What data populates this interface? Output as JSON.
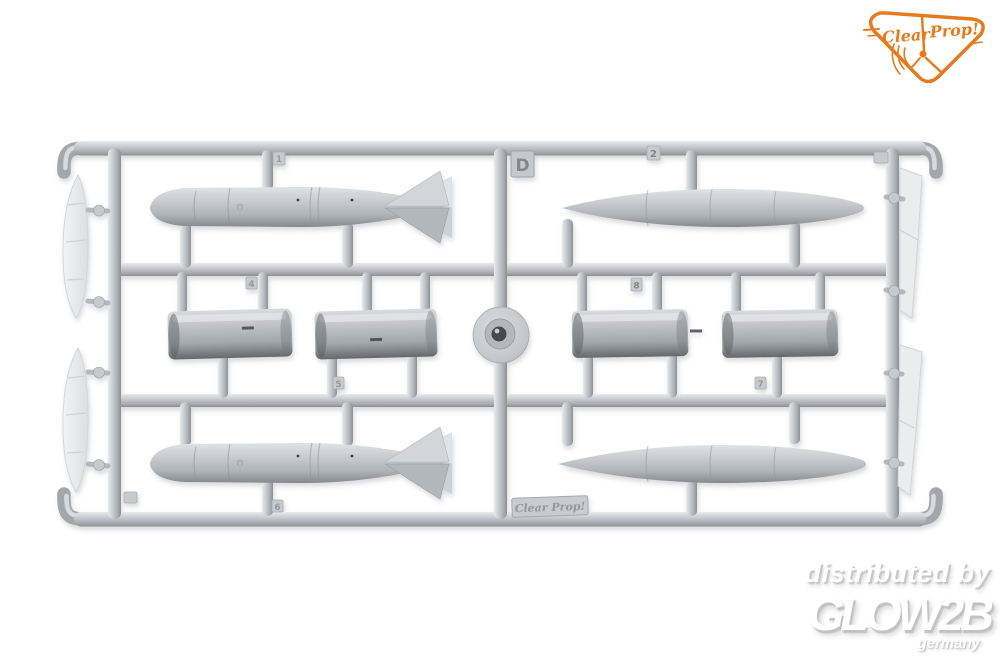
{
  "scene": {
    "description": "product photo of a grey injection-molded model kit sprue with drop tanks, bombs and tank halves",
    "background_color": "#ffffff",
    "plastic_base": "#bfc3c7",
    "plastic_highlight": "#e9ebed",
    "plastic_shadow": "#85898d",
    "parts": [
      "finned-bomb-top-left",
      "drop-tank-top-right",
      "tank-half-left-a",
      "tank-half-left-b",
      "tank-half-right-a",
      "tank-half-right-b",
      "finned-bomb-bottom-left",
      "drop-tank-bottom-right",
      "slat-left-upper",
      "slat-left-lower",
      "flap-right-upper",
      "flap-right-lower",
      "center-sprue-hub"
    ]
  },
  "logo": {
    "word1": "Clear",
    "word2": "Prop!",
    "color": "#e67b1e"
  },
  "sprue": {
    "gate_letter": "D",
    "brand_plate": "Clear Prop!",
    "tags": {
      "n1": "1",
      "n2": "2",
      "n4": "4",
      "n5": "5",
      "n6": "6",
      "n7": "7",
      "n8": "8"
    }
  },
  "watermark": {
    "line1": "distributed by",
    "line2": "GLOW2B",
    "line3": "germany",
    "color": "#ffffff"
  }
}
